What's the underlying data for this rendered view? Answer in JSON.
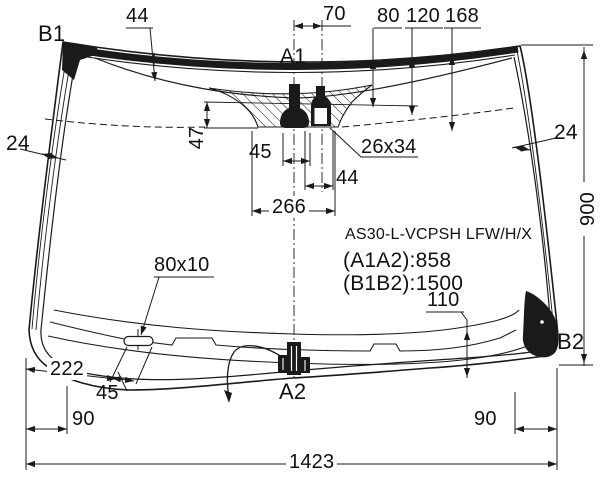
{
  "diagram": {
    "glass_type": "AS30-L-VCPSH LFW/H/X",
    "diagonal_a": "(A1A2):858",
    "diagonal_b": "(B1B2):1500",
    "points": {
      "a1": "A1",
      "a2": "A2",
      "b1": "B1",
      "b2": "B2"
    },
    "dimensions": {
      "top_band_width": "44",
      "mount_spacing": "70",
      "depth_80": "80",
      "depth_120": "120",
      "depth_168": "168",
      "edge_band_left": "24",
      "edge_band_right": "24",
      "shade_band_height": "47",
      "mount_width": "45",
      "bracket_size": "26x34",
      "bracket_width": "44",
      "shade_band_width": "266",
      "slot_size": "80x10",
      "bottom_band_height": "110",
      "glass_height": "900",
      "corner_width": "222",
      "slot_offset": "45",
      "margin_left": "90",
      "margin_right": "90",
      "overall_width": "1423"
    },
    "colors": {
      "line": "#1a1a1a",
      "background": "#ffffff"
    }
  }
}
